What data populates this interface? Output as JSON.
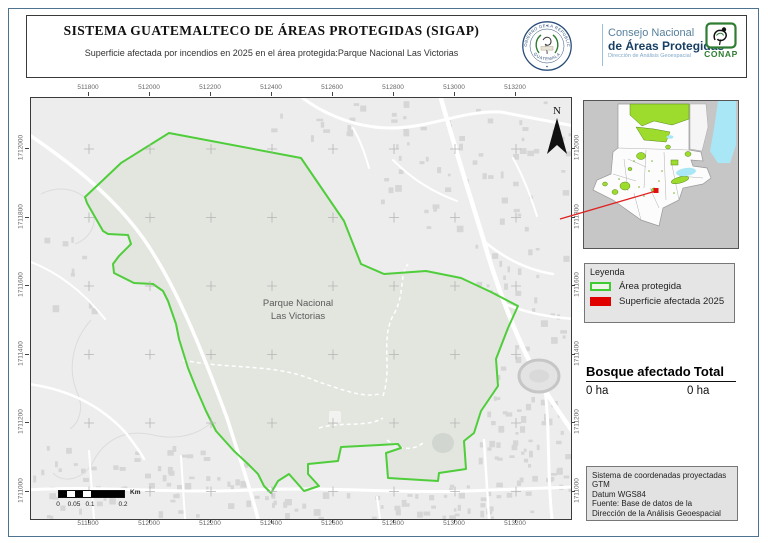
{
  "header": {
    "title": "SISTEMA GUATEMALTECO DE ÁREAS PROTEGIDAS  (SIGAP)",
    "subtitle": "Superficie afectada por incendios en 2025 en el área protegida:Parque Nacional Las Victorias",
    "seal_text_top": "GOBIERNO DE LA REPÚBLICA",
    "seal_text_bottom": "GUATEMALA",
    "org_line1": "Consejo Nacional",
    "org_line2": "de Áreas Protegidas",
    "org_line3": "Dirección de Análisis Geoespacial",
    "conap_label": "CONAP"
  },
  "map": {
    "park_label_line1": "Parque Nacional",
    "park_label_line2": "Las Victorias",
    "north_label": "N",
    "x_ticks": [
      "511800",
      "512000",
      "512200",
      "512400",
      "512600",
      "512800",
      "513000",
      "513200"
    ],
    "y_ticks": [
      "1712000",
      "1711800",
      "1711600",
      "1711400",
      "1711200",
      "1711000"
    ],
    "scale_bar": {
      "labels": [
        "0",
        "0.05",
        "0.1",
        "0.2"
      ],
      "unit": "Km"
    }
  },
  "legend": {
    "title": "Leyenda",
    "items": [
      {
        "label": "Área protegida"
      },
      {
        "label": "Superficie afectada 2025"
      }
    ]
  },
  "stats": {
    "col1_header": "Bosque afectado",
    "col2_header": "Total",
    "col1_value": "0 ha",
    "col2_value": "0 ha"
  },
  "info_box": {
    "lines": [
      "Sistema de coordenadas proyectadas",
      "GTM",
      "Datum WGS84",
      "Fuente: Base de datos de la",
      "Dirección de la Análisis Geoespacial"
    ]
  },
  "colors": {
    "protected_border": "#4fcd3a",
    "affected_fill": "#e00000",
    "inset_protected": "#9ddc2c",
    "water": "#a9e7f7",
    "leader_line": "#e02020"
  }
}
